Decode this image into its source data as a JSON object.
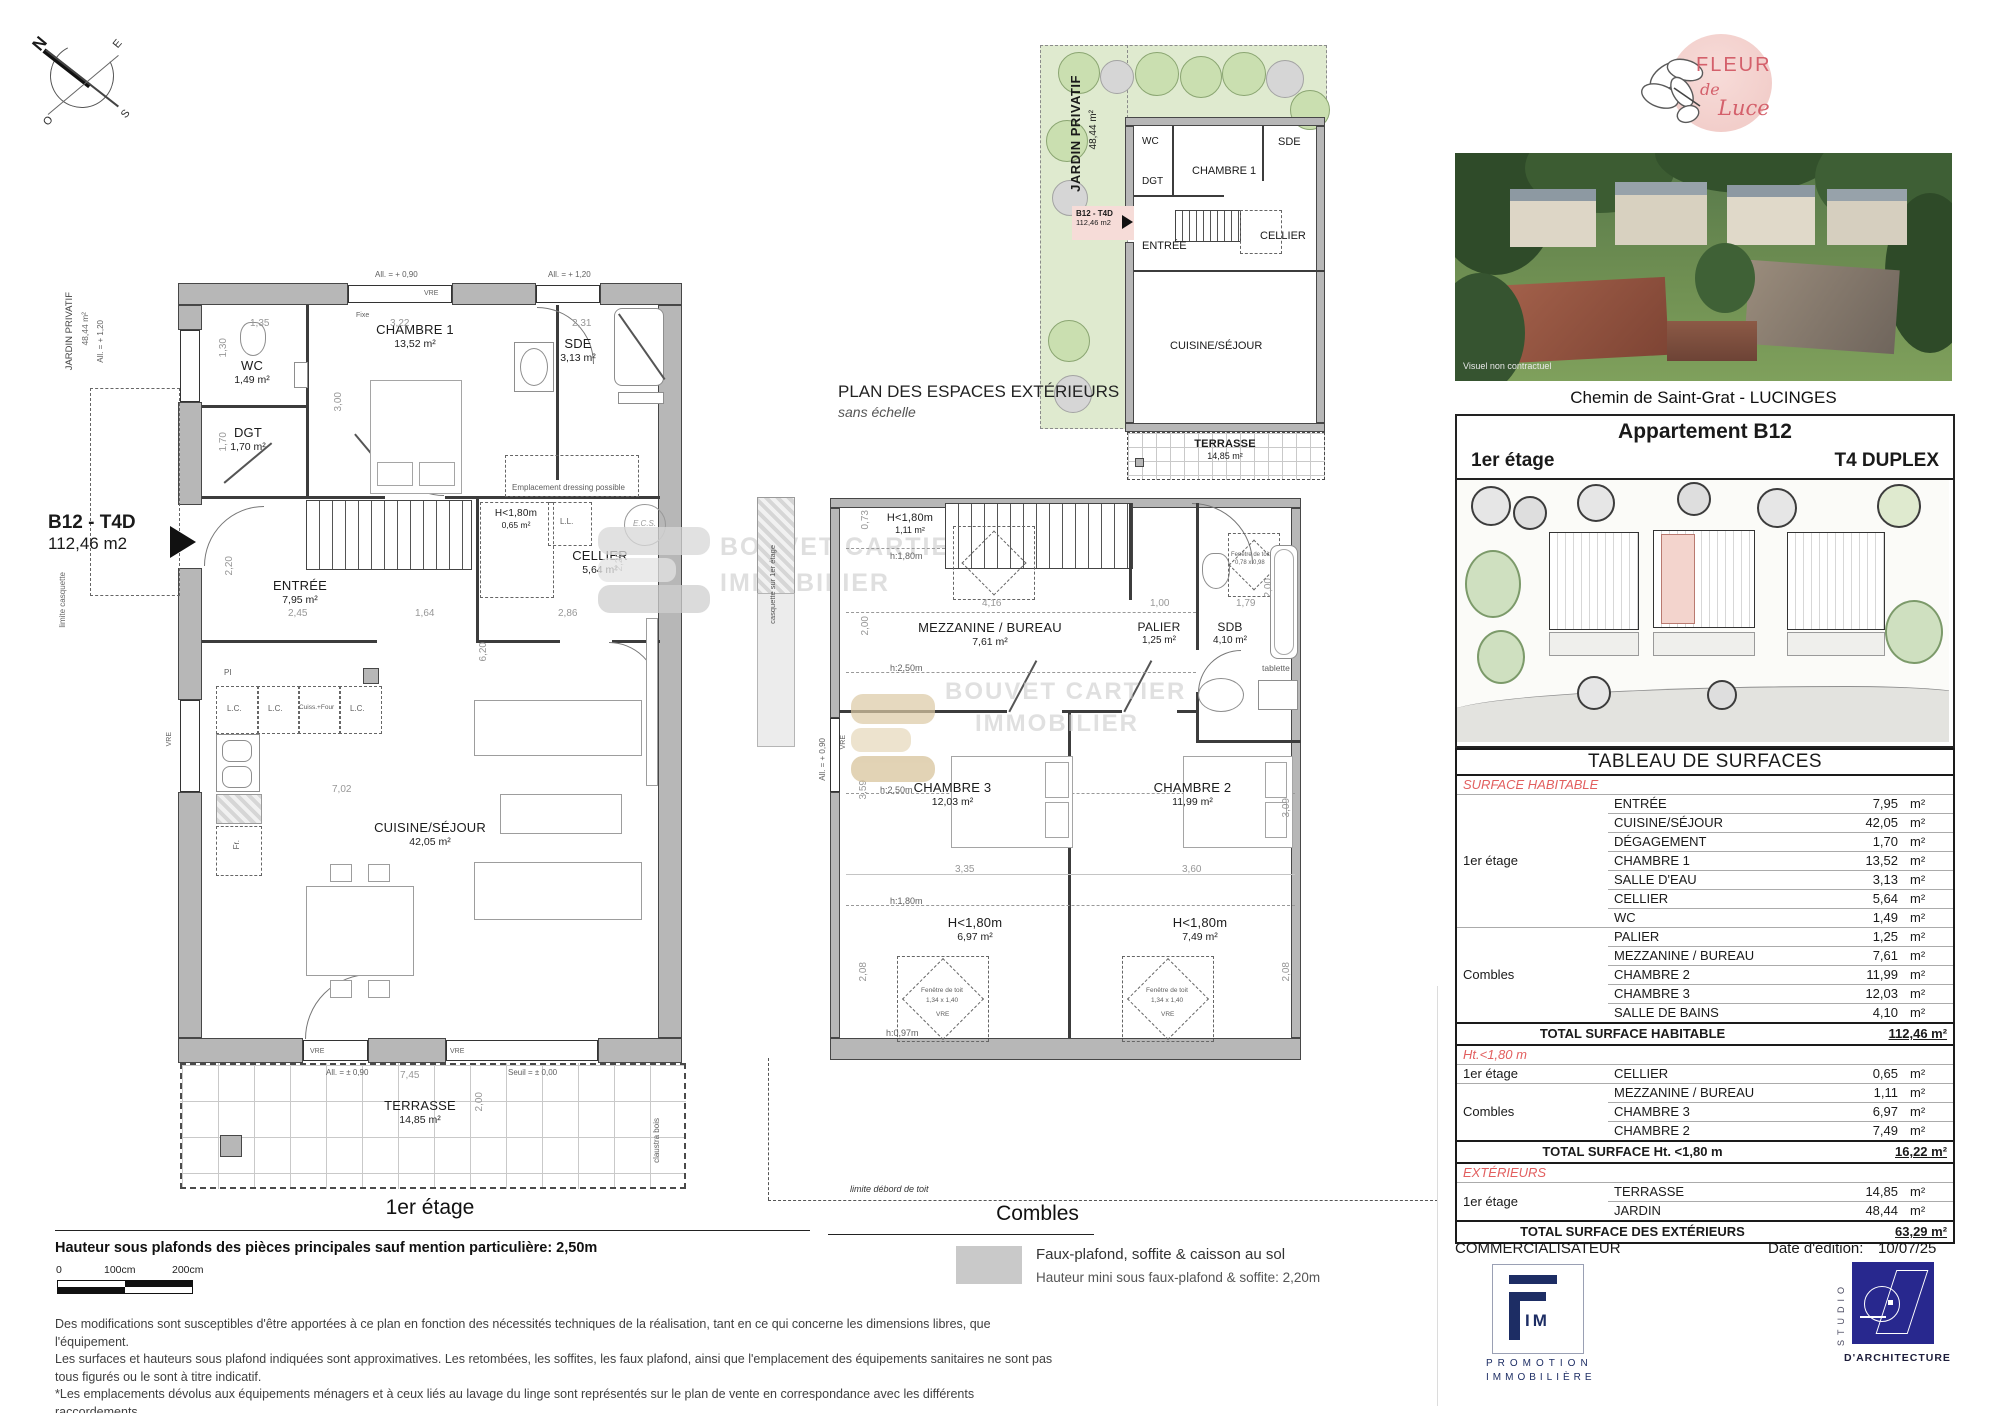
{
  "compass": {
    "n": "N",
    "e": "E",
    "s": "S",
    "o": "O"
  },
  "watermark": {
    "l1": "BOUVET CARTIER",
    "l2": "IMMOBILIER"
  },
  "plan1": {
    "title": "1er étage",
    "b12": {
      "code": "B12 - T4D",
      "area": "112,46 m2"
    },
    "side": {
      "jardin": "JARDIN PRIVATIF",
      "jardin_area": "48,44 m²",
      "limite": "limite casquette"
    },
    "rooms": {
      "wc": {
        "n": "WC",
        "a": "1,49 m²"
      },
      "dgt": {
        "n": "DGT",
        "a": "1,70 m²"
      },
      "ch1": {
        "n": "CHAMBRE 1",
        "a": "13,52 m²"
      },
      "sde": {
        "n": "SDE",
        "a": "3,13 m²"
      },
      "entree": {
        "n": "ENTRÉE",
        "a": "7,95 m²"
      },
      "cellier": {
        "n": "CELLIER",
        "a": "5,64 m²"
      },
      "h180": {
        "n": "H<1,80m",
        "a": "0,65 m²"
      },
      "cuisine": {
        "n": "CUISINE/SÉJOUR",
        "a": "42,05 m²"
      },
      "terrasse": {
        "n": "TERRASSE",
        "a": "14,85 m²"
      }
    },
    "ann": {
      "all090": "All. = + 0,90",
      "all120": "All. = + 1,20",
      "vre": "VRE",
      "fixe": "Fixe",
      "dressing": "Emplacement dressing possible",
      "ll": "L.L.",
      "ecs": "E.C.S.",
      "lc": "L.C.",
      "cuiss": "Cuiss.+Four",
      "fr": "Fr.",
      "pi": "PI",
      "allpm": "All. = ± 0,90",
      "seuil": "Seuil = ± 0,00",
      "claustra": "claustra bois"
    },
    "dims": {
      "d135": "1,35",
      "d322": "3,22",
      "d231": "2,31",
      "d300": "3,00",
      "d130": "1,30",
      "d170": "1,70",
      "d220": "2,20",
      "d245": "2,45",
      "d164": "1,64",
      "d286": "2,86",
      "d620": "6,20",
      "d702": "7,02",
      "d745": "7,45",
      "d200": "2,00"
    }
  },
  "planext": {
    "title": "PLAN DES ESPACES EXTÉRIEURS",
    "subtitle": "sans échelle",
    "jardin": "JARDIN PRIVATIF",
    "jardin_area": "48,44 m²",
    "b12": "B12 - T4D",
    "b12_area": "112,46 m2",
    "rooms": {
      "wc": "WC",
      "dgt": "DGT",
      "ch1": "CHAMBRE 1",
      "sde": "SDE",
      "entree": "ENTRÉE",
      "cellier": "CELLIER",
      "cuisine": "CUISINE/SÉJOUR",
      "terrasse": "TERRASSE",
      "terrasse_area": "14,85 m²"
    }
  },
  "plan2": {
    "title": "Combles",
    "rooms": {
      "mez": {
        "n": "MEZZANINE / BUREAU",
        "a": "7,61 m²"
      },
      "palier": {
        "n": "PALIER",
        "a": "1,25 m²"
      },
      "sdb": {
        "n": "SDB",
        "a": "4,10 m²"
      },
      "ch3": {
        "n": "CHAMBRE 3",
        "a": "12,03 m²"
      },
      "ch2": {
        "n": "CHAMBRE 2",
        "a": "11,99 m²"
      },
      "h1": {
        "n": "H<1,80m",
        "a": "1,11 m²"
      },
      "h3": {
        "n": "H<1,80m",
        "a": "6,97 m²"
      },
      "h2": {
        "n": "H<1,80m",
        "a": "7,49 m²"
      }
    },
    "ann": {
      "h180": "h:1,80m",
      "h250": "h:2,50m",
      "h097": "h:0,97m",
      "tablette": "tablette",
      "fdt": "Fenêtre de toit",
      "fdt1": "1,14 x 1,18",
      "fdt2": "0,78 x 0,98",
      "fdt3": "1,34 x 1,40",
      "vre": "VRE",
      "casquette": "casquette sur 1er étage",
      "all090": "All. = + 0,90",
      "debord": "limite débord de toit"
    },
    "dims": {
      "d073": "0,73",
      "d416": "4,16",
      "d100": "1,00",
      "d179": "1,79",
      "d200": "2,00",
      "d335": "3,35",
      "d360": "3,60",
      "d359": "3,59",
      "d309": "3,09",
      "d208": "2,08"
    },
    "legend": {
      "l1": "Faux-plafond, soffite & caisson au sol",
      "l2": "Hauteur mini sous faux-plafond & soffite: 2,20m"
    }
  },
  "right": {
    "logo": {
      "fleur": "FLEUR",
      "de": "de",
      "luce": "Luce"
    },
    "photo_note": "Visuel non contractuel",
    "address": "Chemin de Saint-Grat - LUCINGES",
    "apt": {
      "title": "Appartement B12",
      "floor": "1er étage",
      "type": "T4 DUPLEX"
    },
    "table": {
      "title": "TABLEAU DE SURFACES",
      "unit": "m²",
      "sections": [
        {
          "label": "SURFACE HABITABLE",
          "groups": [
            {
              "name": "1er étage",
              "rows": [
                [
                  "ENTRÉE",
                  "7,95"
                ],
                [
                  "CUISINE/SÉJOUR",
                  "42,05"
                ],
                [
                  "DÉGAGEMENT",
                  "1,70"
                ],
                [
                  "CHAMBRE 1",
                  "13,52"
                ],
                [
                  "SALLE D'EAU",
                  "3,13"
                ],
                [
                  "CELLIER",
                  "5,64"
                ],
                [
                  "WC",
                  "1,49"
                ]
              ]
            },
            {
              "name": "Combles",
              "rows": [
                [
                  "PALIER",
                  "1,25"
                ],
                [
                  "MEZZANINE / BUREAU",
                  "7,61"
                ],
                [
                  "CHAMBRE 2",
                  "11,99"
                ],
                [
                  "CHAMBRE 3",
                  "12,03"
                ],
                [
                  "SALLE DE BAINS",
                  "4,10"
                ]
              ]
            }
          ],
          "total": [
            "TOTAL SURFACE HABITABLE",
            "112,46 m²"
          ]
        },
        {
          "label": "Ht.<1,80 m",
          "groups": [
            {
              "name": "1er étage",
              "rows": [
                [
                  "CELLIER",
                  "0,65"
                ]
              ]
            },
            {
              "name": "Combles",
              "rows": [
                [
                  "MEZZANINE / BUREAU",
                  "1,11"
                ],
                [
                  "CHAMBRE 3",
                  "6,97"
                ],
                [
                  "CHAMBRE 2",
                  "7,49"
                ]
              ]
            }
          ],
          "total": [
            "TOTAL SURFACE Ht. <1,80 m",
            "16,22 m²"
          ]
        },
        {
          "label": "EXTÉRIEURS",
          "groups": [
            {
              "name": "1er étage",
              "rows": [
                [
                  "TERRASSE",
                  "14,85"
                ],
                [
                  "JARDIN",
                  "48,44"
                ]
              ]
            }
          ],
          "total": [
            "TOTAL SURFACE DES EXTÉRIEURS",
            "63,29 m²"
          ]
        }
      ]
    },
    "comm": {
      "label": "COMMERCIALISATEUR",
      "fim_im": "IM",
      "fim_sub1": "PROMOTION",
      "fim_sub2": "IMMOBILIÈRE"
    },
    "edition": {
      "label": "Date d'édition:",
      "date": "10/07/25"
    },
    "studio": {
      "side": "STUDIO",
      "name": "D'ARCHITECTURE"
    }
  },
  "footer": {
    "note": "Hauteur sous plafonds des pièces principales sauf mention particulière: 2,50m",
    "scale": {
      "s0": "0",
      "s1": "100cm",
      "s2": "200cm"
    },
    "disc1": "Des modifications sont susceptibles d'être apportées à ce plan en fonction des nécessités techniques de la réalisation, tant en ce qui concerne les dimensions libres, que l'équipement.",
    "disc2": "Les surfaces et hauteurs sous plafond indiquées sont approximatives. Les retombées, les soffites, les faux plafond, ainsi que l'emplacement des équipements sanitaires ne sont pas tous figurés ou le sont à titre indicatif.",
    "disc3": "*Les emplacements dévolus aux équipements ménagers et à ceux liés au lavage du linge sont représentés sur le plan de vente en correspondance avec les différents raccordements",
    "disc4": "nécessaires en électricité et en eau, aucun de ces éléments n'est fourni, à l'exception de l'évier sur meuble suivant descriptif."
  }
}
